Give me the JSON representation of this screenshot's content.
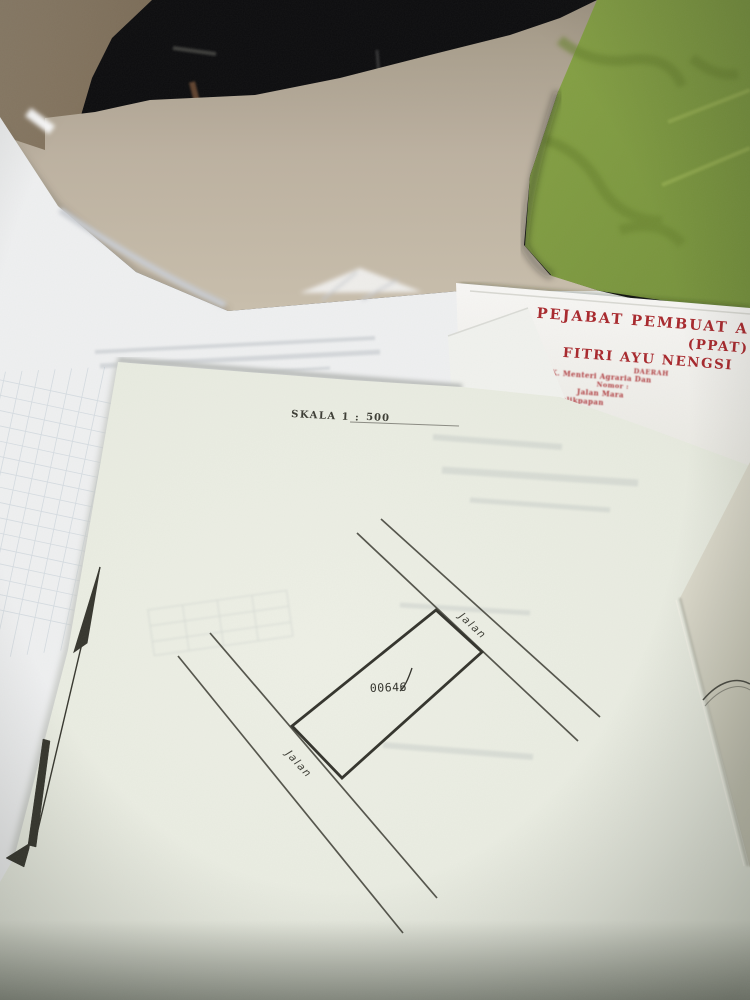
{
  "scene": {
    "colors": {
      "background": "#0b0b0d",
      "wall": "#7d6c58",
      "floor": "#beb3a2",
      "rug_green": "#7e9a3d",
      "rug_pattern": "#69832e",
      "paper_white": "#eff0f1",
      "survey_paper": "#e9ece1",
      "folder_cream": "#e2dfd0",
      "map_ink": "#3b3b33",
      "ppat_red": "#a8262b"
    }
  },
  "survey_sketch": {
    "scale_label": "SKALA 1 :",
    "scale_value": "500",
    "parcel_number": "00646",
    "road_top_label": "Jalan",
    "road_bottom_label": "Jalan"
  },
  "ppat_document": {
    "title": "PEJABAT PEMBUAT A",
    "subtitle": "(PPAT)",
    "officer_name": "FITRI AYU NENGSI",
    "region_line": "DAERAH",
    "sk_line": "SK. Menteri Agraria Dan",
    "number_line": "Nomor :",
    "address_line": "Jalan Mara",
    "city_line": "Balikpapan"
  }
}
